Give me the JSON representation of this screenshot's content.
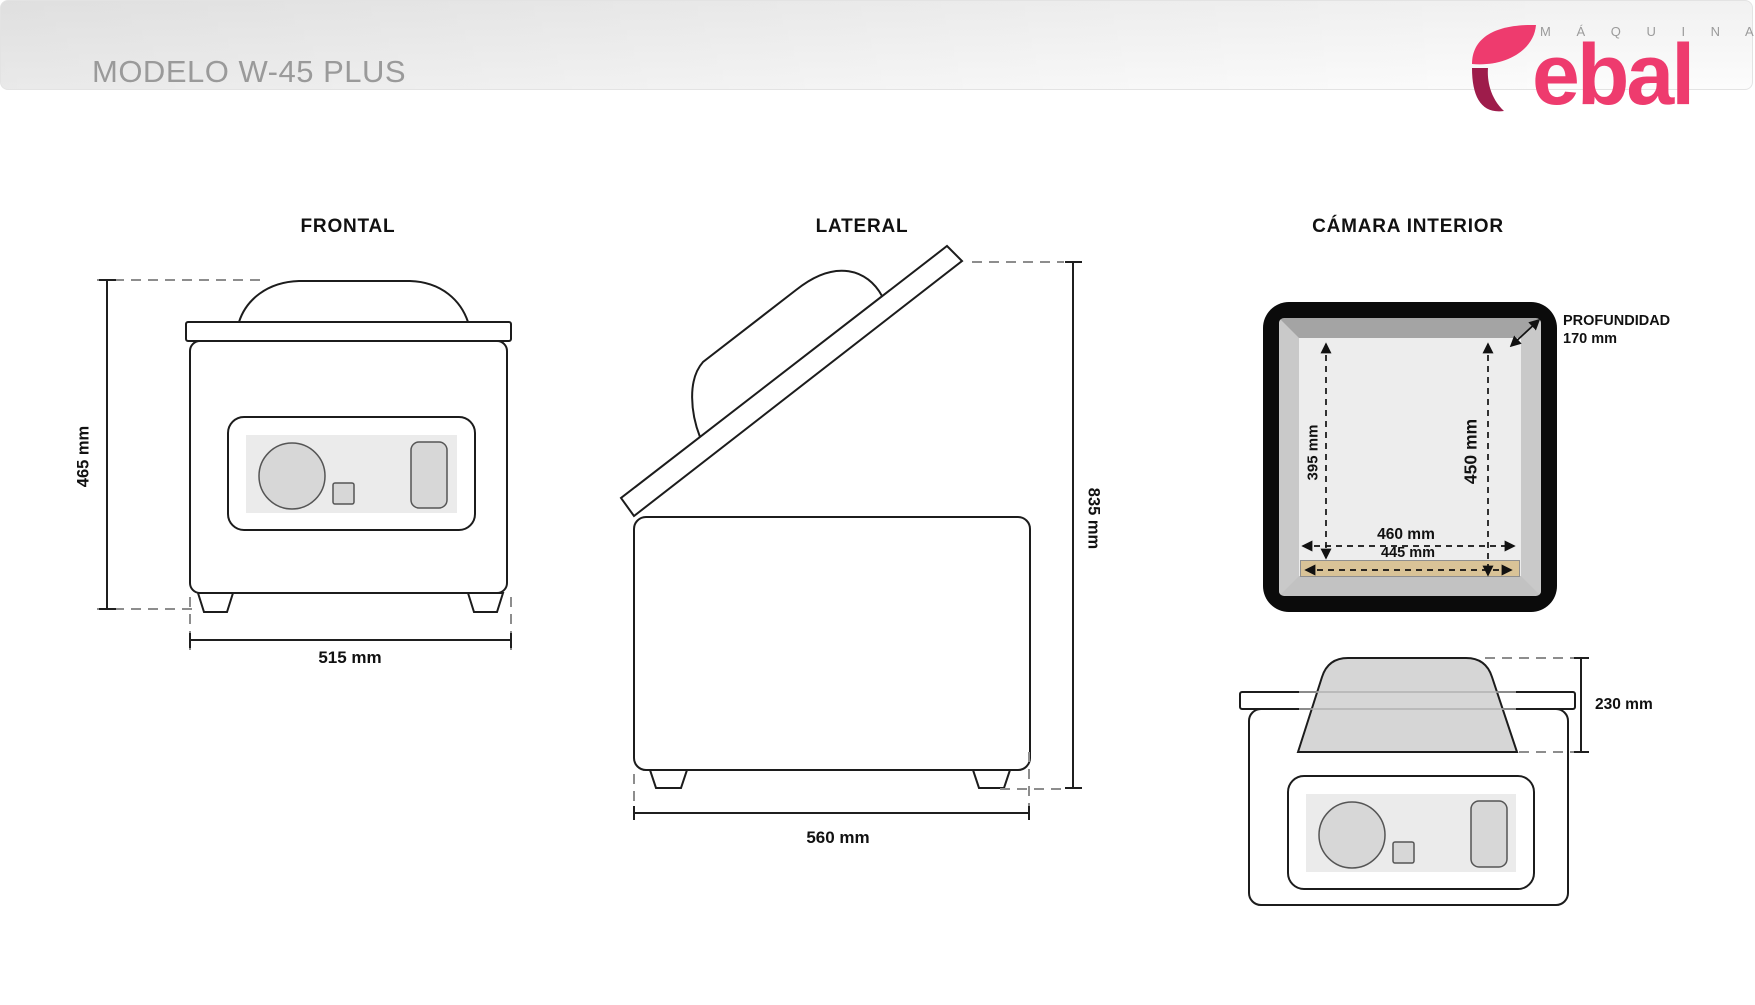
{
  "header": {
    "model_title": "MODELO W-45 PLUS",
    "brand": {
      "tagline": "M Á Q U I N A S",
      "name_rest": "ebal"
    }
  },
  "views": {
    "frontal": {
      "title": "FRONTAL",
      "height": "465 mm",
      "width": "515 mm"
    },
    "lateral": {
      "title": "LATERAL",
      "height": "835 mm",
      "depth": "560 mm"
    },
    "camara": {
      "title": "CÁMARA INTERIOR",
      "depth_label": "PROFUNDIDAD",
      "depth_value": "170 mm",
      "inner_height_left": "395 mm",
      "inner_height_right": "450 mm",
      "inner_width": "460 mm",
      "seal_bar_width": "445 mm",
      "dome_height": "230 mm"
    }
  },
  "colors": {
    "brand_pink": "#ee3b6e",
    "brand_dark": "#9e1c4b",
    "line": "#1c1c1c",
    "seal_bar": "#d9c397",
    "chamber_frame": "#0b0b0b"
  }
}
